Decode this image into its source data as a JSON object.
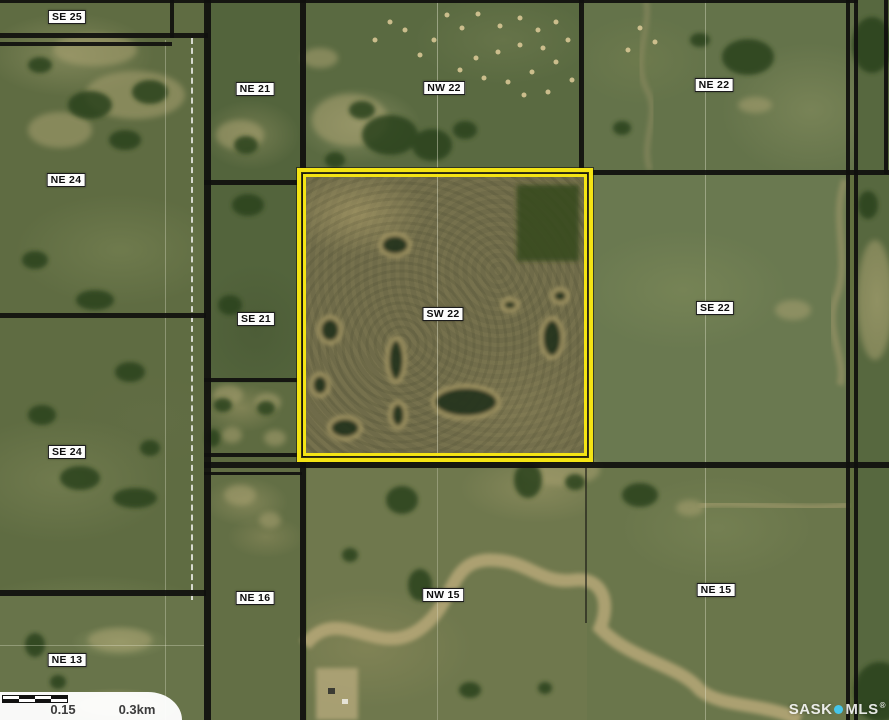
{
  "map": {
    "type": "aerial-parcel-map",
    "region": "rural quarter-section grid",
    "highlighted_parcel": "SW 22",
    "labels": [
      {
        "id": "se25",
        "text": "SE 25"
      },
      {
        "id": "ne21",
        "text": "NE 21"
      },
      {
        "id": "nw22",
        "text": "NW 22"
      },
      {
        "id": "ne22",
        "text": "NE 22"
      },
      {
        "id": "ne24",
        "text": "NE 24"
      },
      {
        "id": "se21",
        "text": "SE 21"
      },
      {
        "id": "sw22",
        "text": "SW 22"
      },
      {
        "id": "se22",
        "text": "SE 22"
      },
      {
        "id": "se24",
        "text": "SE 24"
      },
      {
        "id": "ne16",
        "text": "NE 16"
      },
      {
        "id": "nw15",
        "text": "NW 15"
      },
      {
        "id": "ne15",
        "text": "NE 15"
      },
      {
        "id": "ne13",
        "text": "NE 13"
      }
    ]
  },
  "scalebar": {
    "mid_label": "0.15",
    "end_label": "0.3km"
  },
  "watermark": {
    "part1": "SASK",
    "part2": "MLS",
    "registered": "®"
  },
  "colors": {
    "highlight_yellow": "#f4e414",
    "boundary_black": "#10100e",
    "watermark_dot_cyan": "#45c6ea",
    "label_background": "#fdfdfc"
  }
}
